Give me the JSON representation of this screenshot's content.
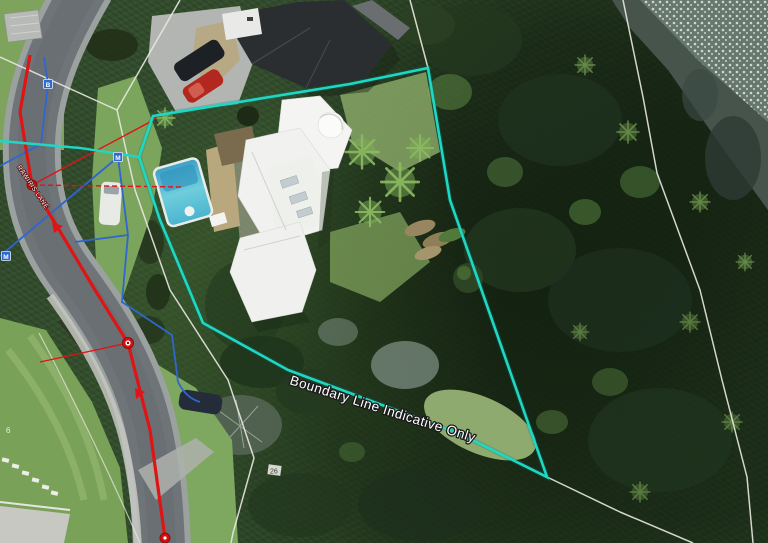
{
  "viewport": {
    "title": "Aerial parcel map",
    "description": "Aerial GIS view with indicative property boundary, cadastral lines and utility networks"
  },
  "labels": {
    "boundary_note": "Boundary Line Indicative Only",
    "road_name": "RAWIRIS LANE",
    "lot_number_main": "7",
    "lot_number_26": "26",
    "lot_number_6": "6"
  },
  "markers": [
    {
      "letter": "B"
    },
    {
      "letter": "M"
    },
    {
      "letter": "M"
    }
  ],
  "layers": {
    "colors": {
      "boundary_cyan": "#1ed8c6",
      "water_blue": "#2f66cf",
      "power_red": "#df1414",
      "cadastral_grey": "#e9e9e1",
      "label_white": "#ffffff"
    }
  }
}
